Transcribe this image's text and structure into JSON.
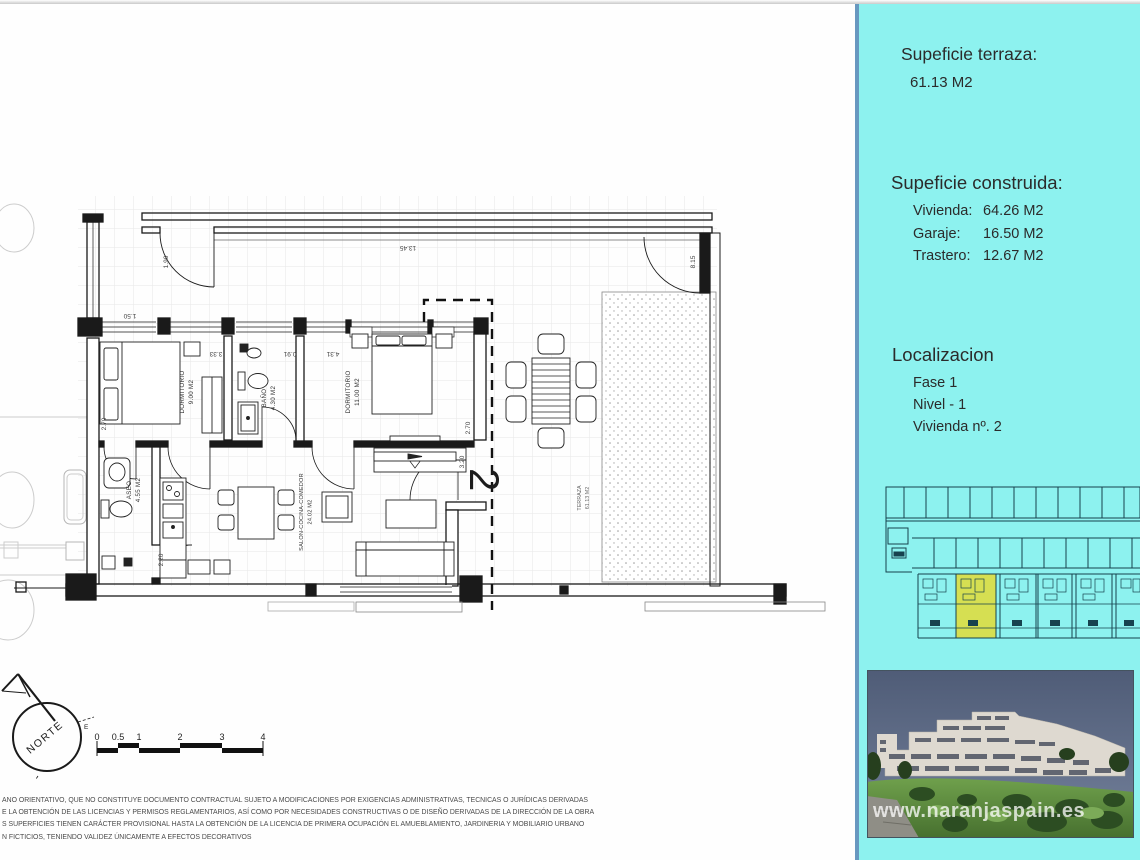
{
  "sidebar": {
    "surface_terrace": {
      "title": "Supeficie terraza:",
      "value": "61.13 M2"
    },
    "surface_built": {
      "title": "Supeficie construida:",
      "rows": [
        {
          "label": "Vivienda:",
          "value": "64.26 M2"
        },
        {
          "label": "Garaje:",
          "value": "16.50 M2"
        },
        {
          "label": "Trastero:",
          "value": "12.67 M2"
        }
      ]
    },
    "location": {
      "title": "Localizacion",
      "lines": [
        "Fase 1",
        "Nivel - 1",
        "Vivienda nº. 2"
      ]
    }
  },
  "photo": {
    "watermark": "www.naranjaspain.es"
  },
  "plan": {
    "unit_number": "2",
    "compass_label": "NORTE",
    "scale_ticks": [
      "0",
      "0.5",
      "1",
      "2",
      "3",
      "4"
    ],
    "rooms": [
      {
        "name": "DORMITORIO",
        "area": "9.00 M2"
      },
      {
        "name": "BAÑO",
        "area": "4.30 M2"
      },
      {
        "name": "DORMITORIO",
        "area": "11.00 M2"
      },
      {
        "name": "ASEO",
        "area": "4.55 M2"
      },
      {
        "name": "SALON-COCINA-COMEDOR",
        "area": "24.02 M2"
      },
      {
        "name": "TERRAZA",
        "area": "61.13 M2"
      }
    ],
    "dimensions": [
      "13.45",
      "8.15",
      "1.90",
      "1.50",
      "2.70",
      "3.33",
      "0.91",
      "4.31",
      "2.70",
      "3.20",
      "2.20"
    ]
  },
  "disclaimer": {
    "lines": [
      "ANO ORIENTATIVO, QUE NO CONSTITUYE DOCUMENTO CONTRACTUAL SUJETO A MODIFICACIONES  POR EXIGENCIAS ADMINISTRATIVAS, TECNICAS O JURÍDICAS DERIVADAS",
      "E LA OBTENCIÓN DE LAS LICENCIAS Y PERMISOS REGLAMENTARIOS, ASÍ COMO POR NECESIDADES CONSTRUCTIVAS  O DE DISEÑO DERIVADAS DE LA DIRECCIÓN DE LA OBRA",
      "S SUPERFICIES TIENEN CARÁCTER PROVISIONAL HASTA LA OBTENCIÓN DE LA LICENCIA DE PRIMERA OCUPACIÓN   EL AMUEBLAMIENTO, JARDINERIA Y MOBILIARIO URBANO",
      "N FICTICIOS, TENIENDO VALIDEZ ÚNICAMENTE  A EFECTOS DECORATIVOS"
    ]
  },
  "colors": {
    "sidebar_background": "#8DF2EF",
    "sidebar_border": "#6898C0",
    "highlight_unit": "#D6DF52",
    "plan_line": "#1a1a1a"
  }
}
